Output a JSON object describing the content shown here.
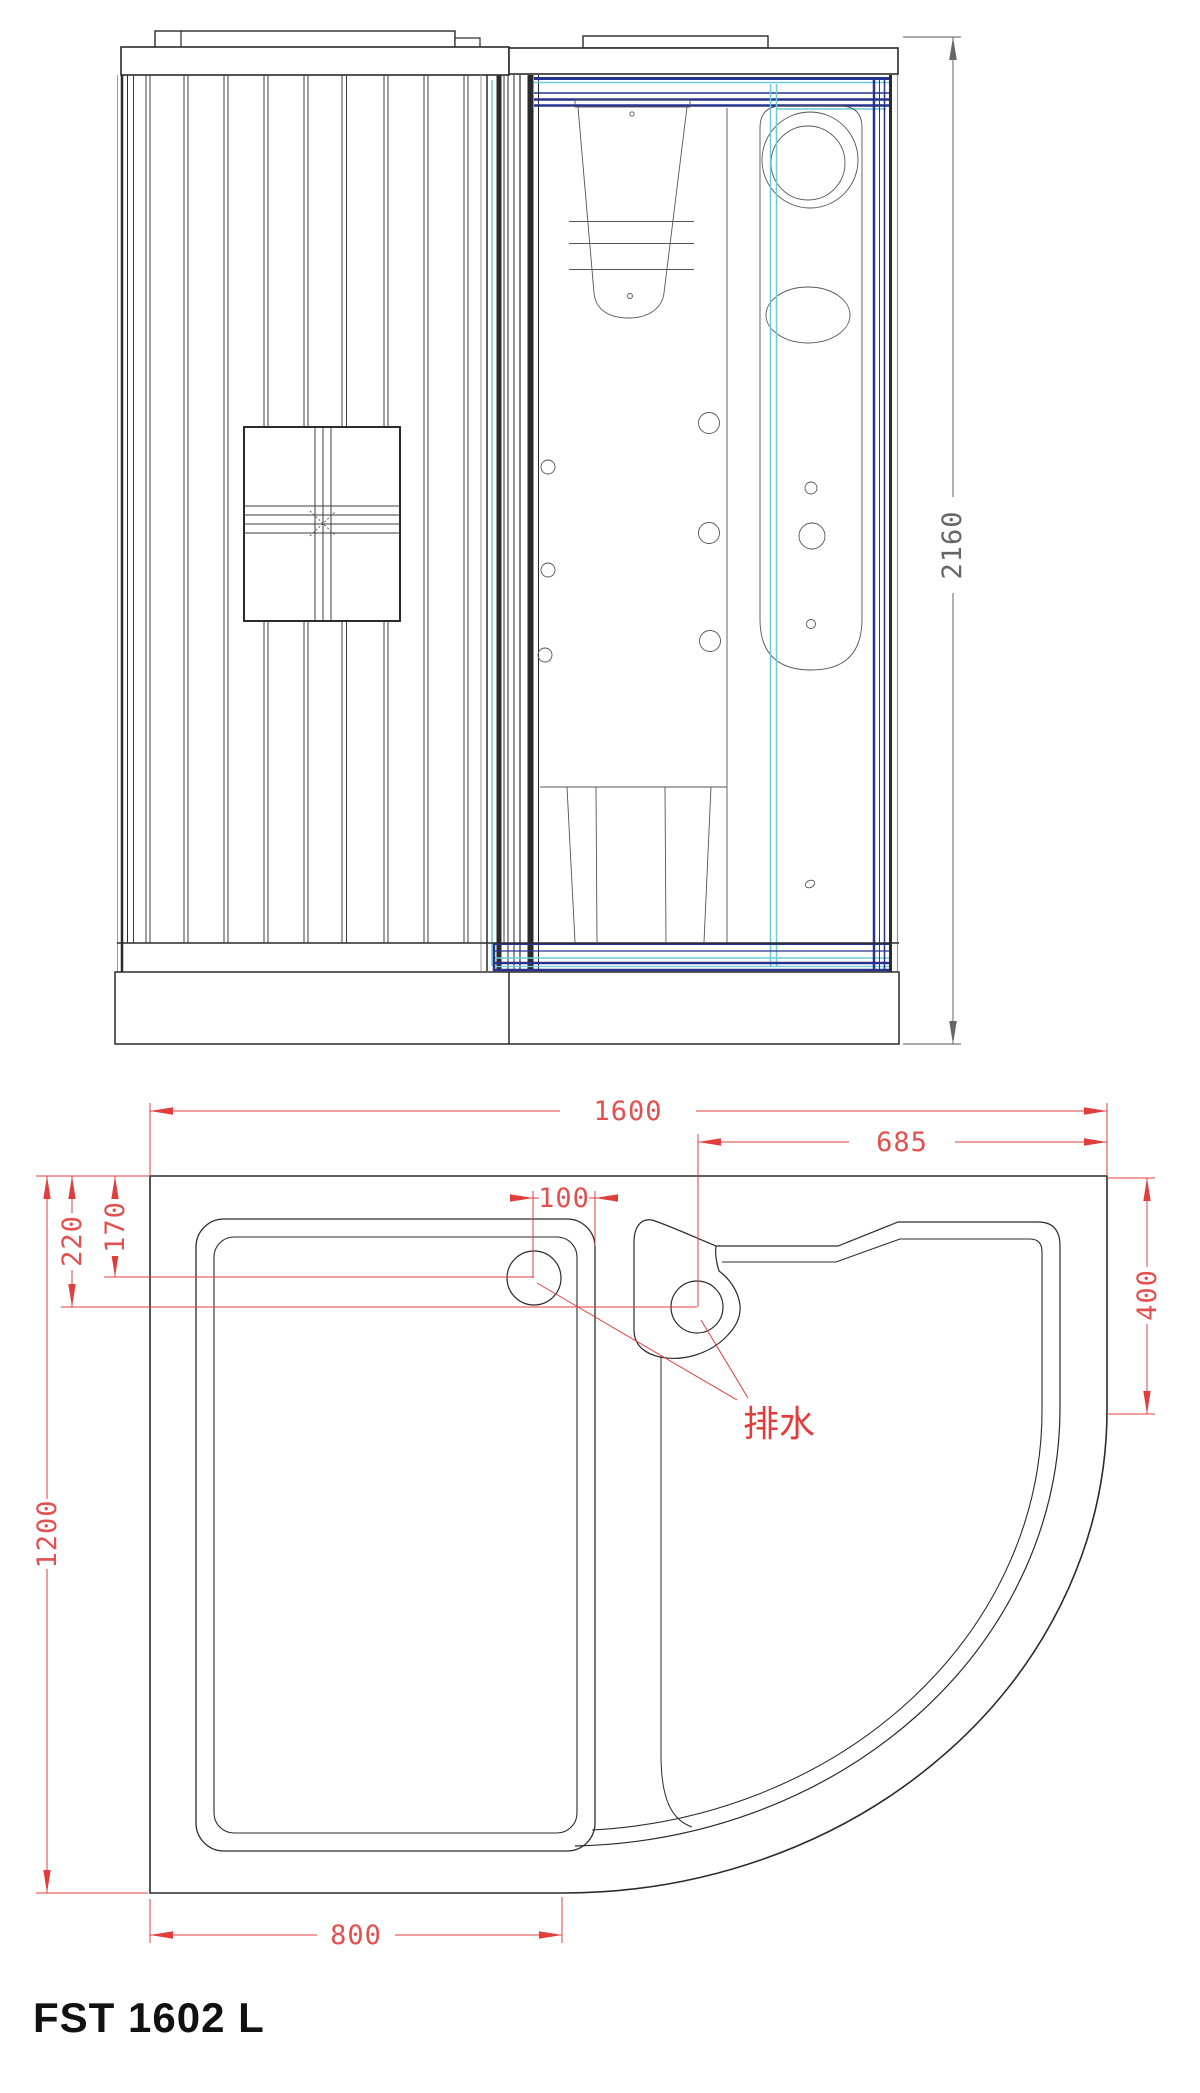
{
  "title": "FST 1602 L",
  "colors": {
    "line": "#2b2b2b",
    "frame_navy": "#26338f",
    "glass_cyan": "#6fcbd8",
    "dimension_red": "#e23d3d",
    "dimension_gray": "#666666"
  },
  "elevation": {
    "height": "2160"
  },
  "plan": {
    "width_total": "1600",
    "right_section_width": "685",
    "drain_offset": "100",
    "drain_left_depth": "170",
    "drain_right_depth": "220",
    "right_edge_depth": "400",
    "depth_total": "1200",
    "left_section_width": "800",
    "drain_label": "排水"
  }
}
